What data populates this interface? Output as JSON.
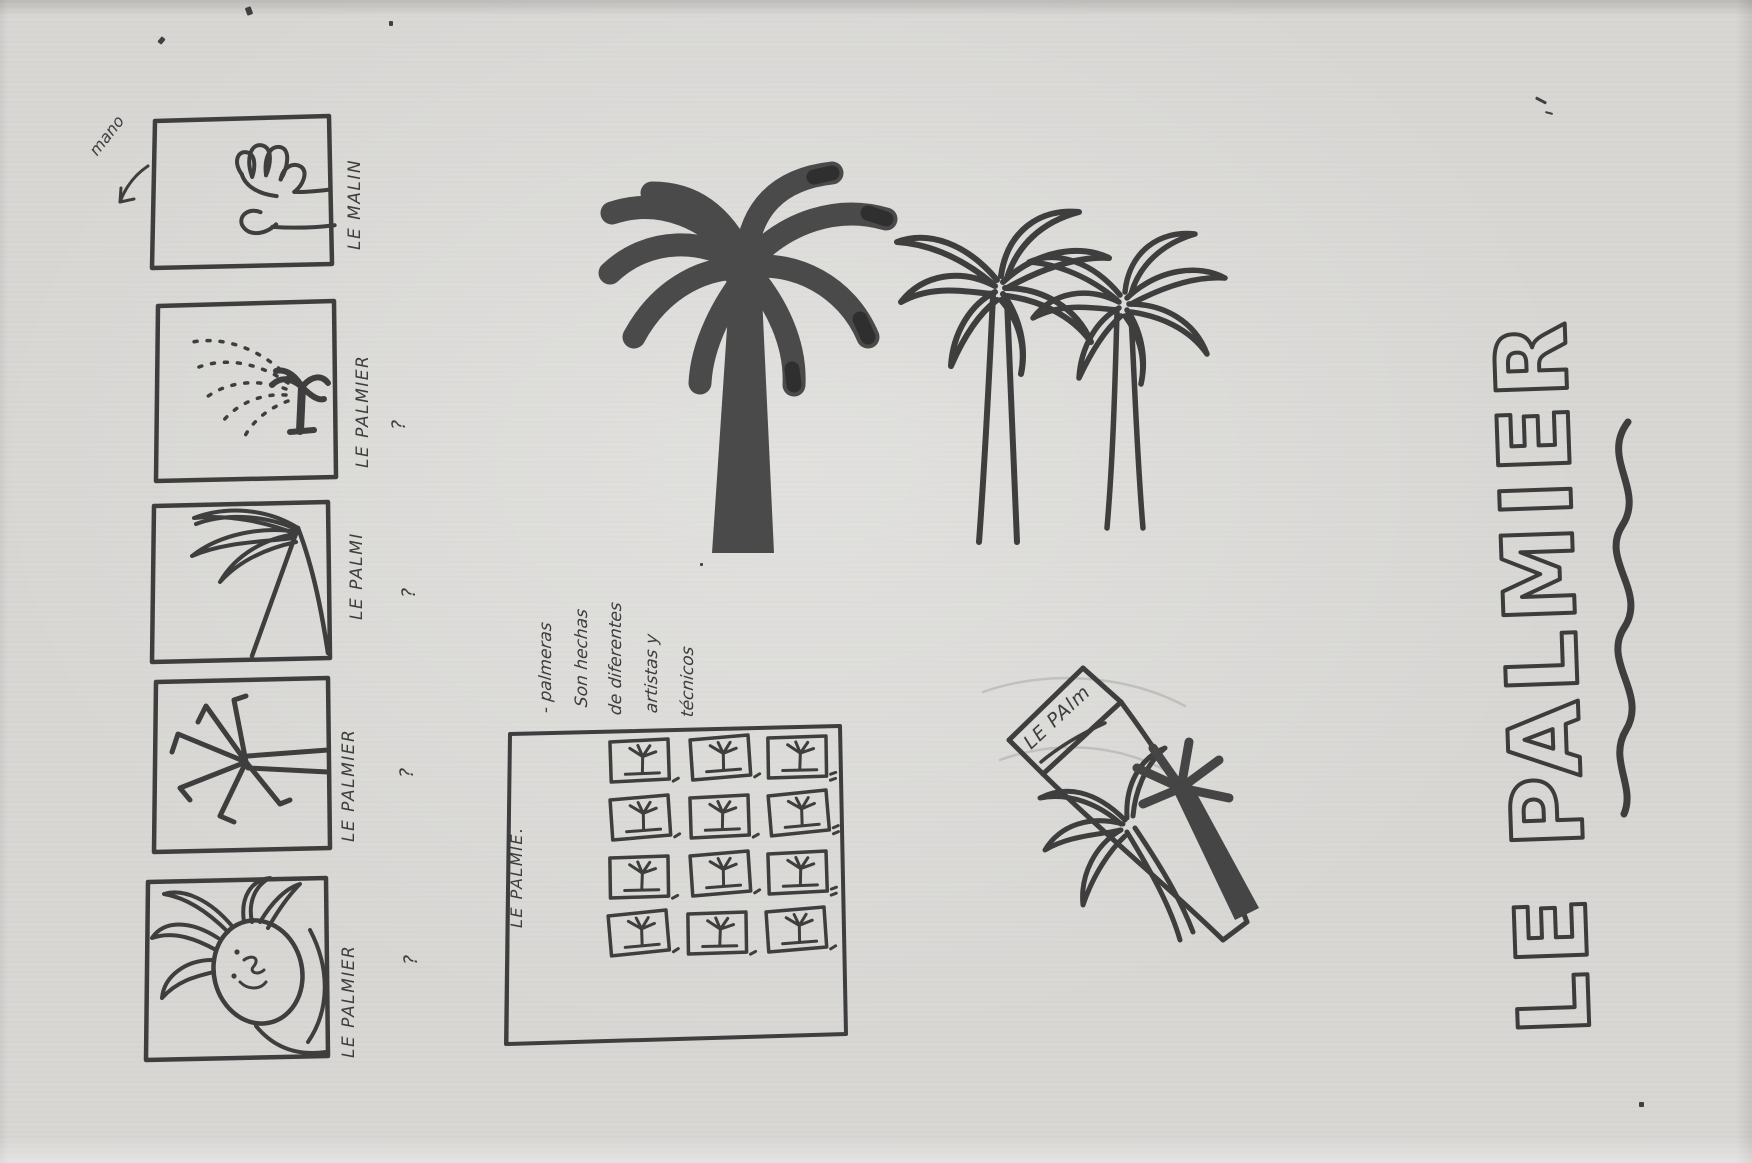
{
  "colors": {
    "paper": "#d8d7d4",
    "ink": "#3e3e3e",
    "ink_dark": "#4a4a4a"
  },
  "annotation": {
    "mano": "mano"
  },
  "left_column": {
    "boxes": [
      {
        "caption": "LE MALIN",
        "mark": ""
      },
      {
        "caption": "LE PALMIER",
        "mark": "?"
      },
      {
        "caption": "LE PALMI",
        "mark": "?"
      },
      {
        "caption": "LE PALMIER",
        "mark": "?"
      },
      {
        "caption": "LE PALMIER",
        "mark": "?"
      }
    ]
  },
  "notes": {
    "lines": [
      "- palmeras",
      "Son hechas",
      "de diferentes",
      "artistas y",
      "técnicos"
    ]
  },
  "layout_sketch": {
    "title": "LE PALMIE."
  },
  "package_sketch": {
    "label": "LE PAlm"
  },
  "big_title": {
    "text": "LE PALMIER"
  }
}
